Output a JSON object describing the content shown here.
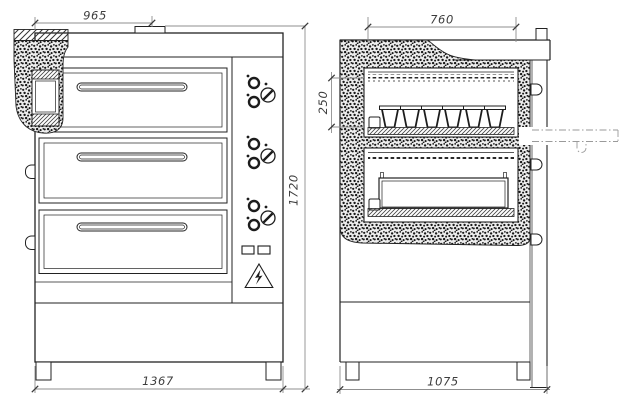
{
  "drawing_type": "oven-technical-drawing",
  "dimensions": {
    "front": {
      "top_width": "965",
      "height": "1720",
      "base_width": "1367"
    },
    "side": {
      "top_depth": "760",
      "chamber_height": "250",
      "base_depth": "1075"
    }
  },
  "icons": {
    "hazard": "electrical-hazard-triangle"
  },
  "colors": {
    "line": "#222222",
    "dim_line": "#8f8f8f",
    "text": "#3d3d3d",
    "background": "#ffffff"
  }
}
